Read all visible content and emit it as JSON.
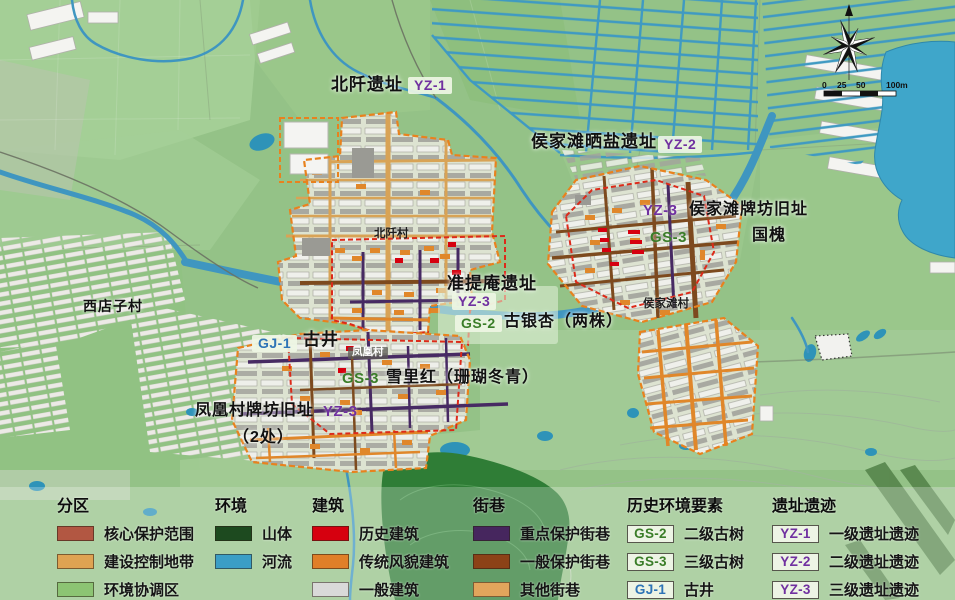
{
  "map": {
    "labels": {
      "beiqian_site": "北阡遗址",
      "beiqian_tag": "YZ-1",
      "saltworks_site": "侯家滩晒盐遗址",
      "saltworks_tag": "YZ-2",
      "houjiatan_paifang": "侯家滩牌坊旧址",
      "houjiatan_tag": "YZ-3",
      "houjiatan_tree_tag": "GS-3",
      "guohuai": "国槐",
      "zhuntian_site": "准提庵遗址",
      "zhuntian_tag": "YZ-3",
      "ginkgo_tag": "GS-2",
      "ginkgo": "古银杏（两株）",
      "well_tag": "GJ-1",
      "well": "古井",
      "fenghuang_village": "凤凰村",
      "xuelihong_tag": "GS-3",
      "xuelihong": "雪里红（珊瑚冬青）",
      "fenghuang_paifang": "凤凰村牌坊旧址",
      "fenghuang_paifang2": "（2处）",
      "fenghuang_tag": "YZ-3",
      "xidianzi_village": "西店子村",
      "beiqian_village": "北阡村",
      "houjiatan_village": "侯家滩村"
    },
    "scale": {
      "labels": [
        "0",
        "25",
        "50",
        "100m"
      ]
    }
  },
  "colors": {
    "tree_tag": "#3a7d28",
    "well_tag": "#2e74b6",
    "site_tag": "#7030a0",
    "core_boundary": "#dc2a1a",
    "control_boundary": "#e8821e",
    "river": "#3f96c0"
  },
  "legend": {
    "sections": [
      {
        "title": "分区",
        "items": [
          {
            "label": "核心保护范围",
            "color": "#b25742"
          },
          {
            "label": "建设控制地带",
            "color": "#dfa352"
          },
          {
            "label": "环境协调区",
            "color": "#8cc473"
          }
        ]
      },
      {
        "title": "环境",
        "items": [
          {
            "label": "山体",
            "color": "#1d4a1f"
          },
          {
            "label": "河流",
            "color": "#3b9ec6"
          }
        ]
      },
      {
        "title": "建筑",
        "items": [
          {
            "label": "历史建筑",
            "color": "#d6000f"
          },
          {
            "label": "传统风貌建筑",
            "color": "#e07f28"
          },
          {
            "label": "一般建筑",
            "color": "#d9d9d9"
          }
        ]
      },
      {
        "title": "街巷",
        "items": [
          {
            "label": "重点保护街巷",
            "color": "#46265e"
          },
          {
            "label": "一般保护街巷",
            "color": "#8c4217"
          },
          {
            "label": "其他街巷",
            "color": "#e2a55c"
          }
        ]
      },
      {
        "title": "历史环境要素",
        "items": [
          {
            "tag": "GS-2",
            "tag_color": "#3a7d28",
            "label": "二级古树"
          },
          {
            "tag": "GS-3",
            "tag_color": "#3a7d28",
            "label": "三级古树"
          },
          {
            "tag": "GJ-1",
            "tag_color": "#2e74b6",
            "label": "古井"
          }
        ]
      },
      {
        "title": "遗址遗迹",
        "items": [
          {
            "tag": "YZ-1",
            "tag_color": "#7030a0",
            "label": "一级遗址遗迹"
          },
          {
            "tag": "YZ-2",
            "tag_color": "#7030a0",
            "label": "二级遗址遗迹"
          },
          {
            "tag": "YZ-3",
            "tag_color": "#7030a0",
            "label": "三级遗址遗迹"
          }
        ]
      }
    ]
  }
}
